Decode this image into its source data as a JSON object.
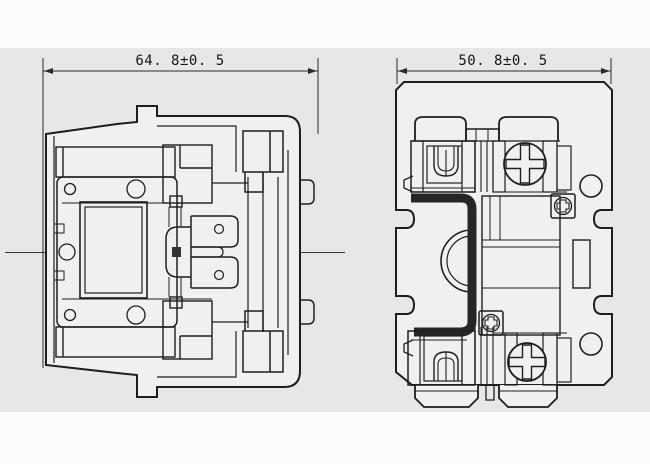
{
  "drawing": {
    "views": {
      "left": {
        "id": "side-view",
        "dimension_label": "64. 8±0. 5"
      },
      "right": {
        "id": "front-view",
        "dimension_label": "50. 8±0. 5"
      }
    }
  },
  "colors": {
    "line": "#1e1e1e",
    "panel_background": "#e7e7e7",
    "page_background": "#fbfbfb",
    "part_fill": "#f0f0f0"
  }
}
